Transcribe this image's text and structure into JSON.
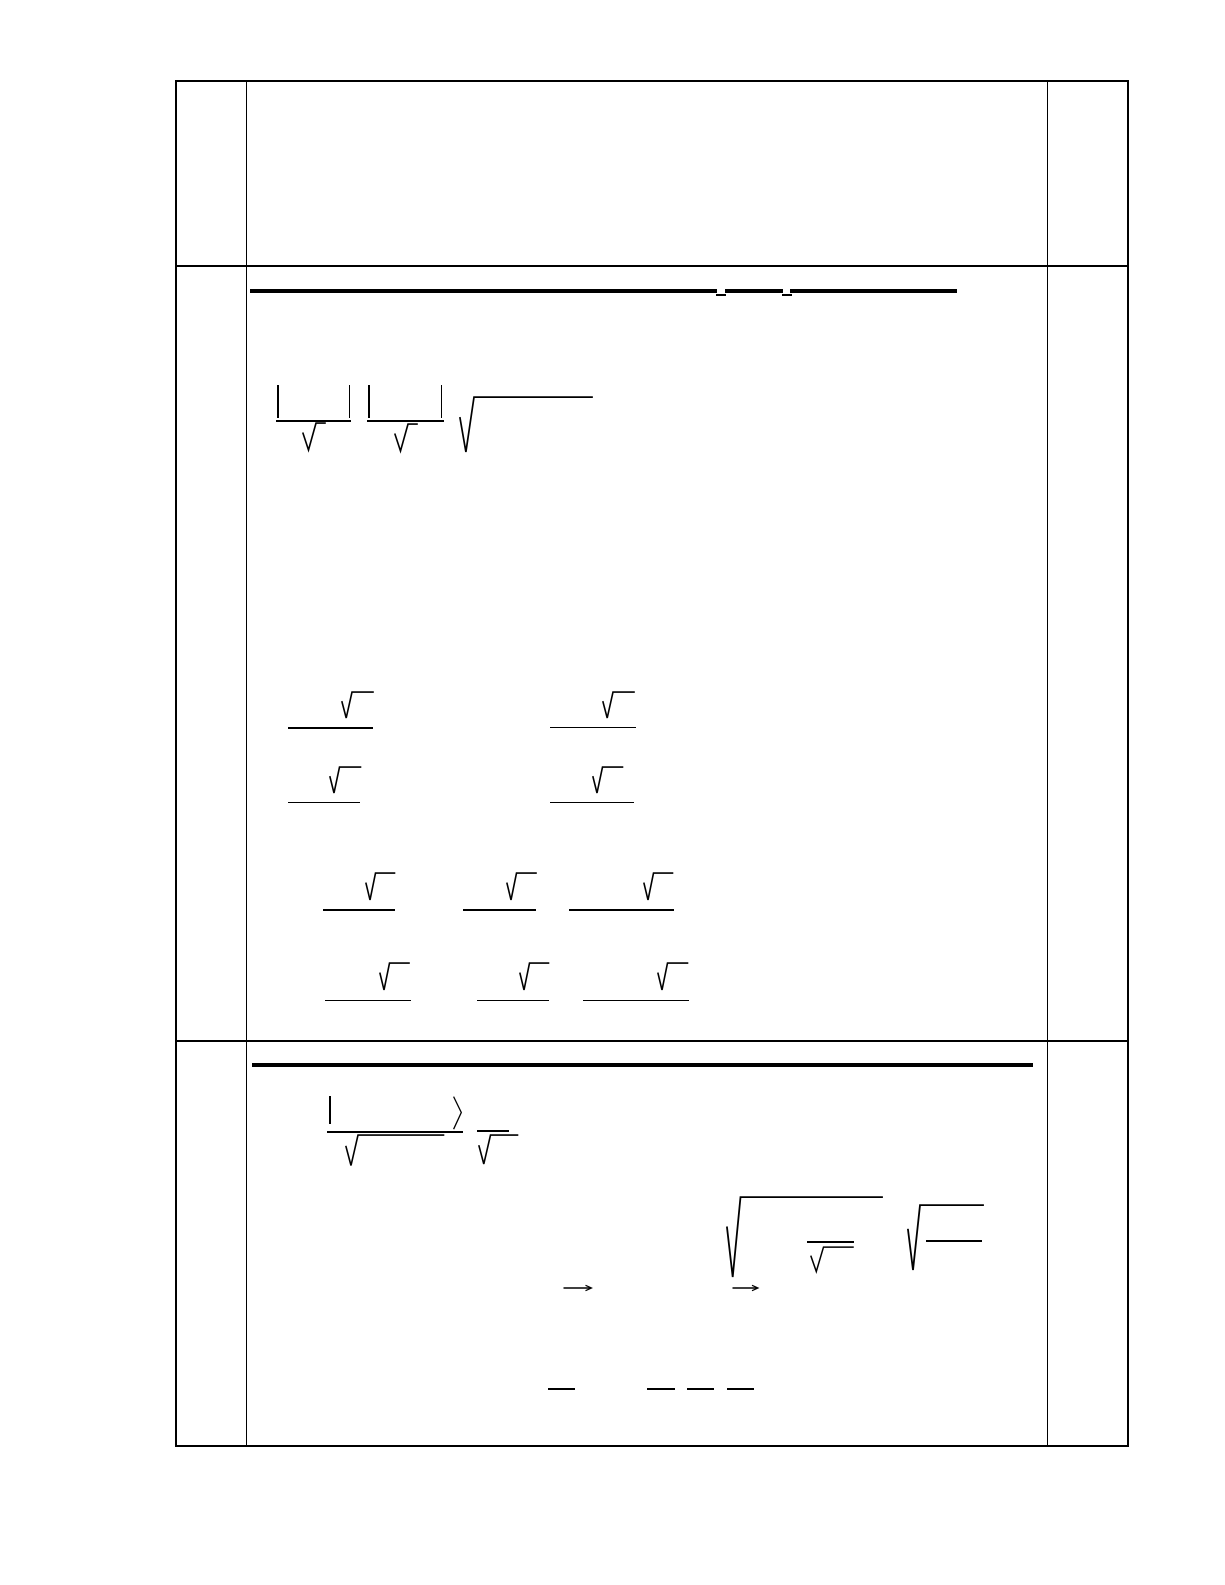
{
  "page": {
    "width": 1225,
    "height": 1585,
    "paper": "#ffffff",
    "ink": "#000000"
  },
  "table": {
    "left": 175,
    "top": 80,
    "right": 1127,
    "bottom": 1444.8,
    "outer_stroke": 2.4,
    "inner_stroke": 1.9,
    "column_x": [
      245.5,
      1046.5
    ],
    "row_y": [
      265.3,
      1040
    ]
  },
  "primitives": [
    {
      "type": "hline",
      "name": "s1-title-rule-seg-1",
      "x": 250,
      "y": 288.5,
      "w": 466.5,
      "t": 4.6
    },
    {
      "type": "hline",
      "name": "s1-title-underscore-1",
      "x": 715.5,
      "y": 294,
      "w": 10,
      "t": 2.2
    },
    {
      "type": "hline",
      "name": "s1-title-rule-seg-2",
      "x": 725,
      "y": 288.5,
      "w": 58,
      "t": 4.6
    },
    {
      "type": "hline",
      "name": "s1-title-underscore-2",
      "x": 781.5,
      "y": 294,
      "w": 10,
      "t": 2.2
    },
    {
      "type": "hline",
      "name": "s1-title-rule-seg-3",
      "x": 790,
      "y": 288.5,
      "w": 167,
      "t": 4.6
    },
    {
      "type": "vline",
      "name": "s1-abs1-left-bar",
      "x": 277,
      "y": 384.5,
      "h": 33,
      "t": 1.7
    },
    {
      "type": "vline",
      "name": "s1-abs1-right-bar",
      "x": 348.5,
      "y": 384.5,
      "h": 33,
      "t": 1.7
    },
    {
      "type": "hline",
      "name": "s1-abs1-fraction-bar",
      "x": 276,
      "y": 419.5,
      "w": 75,
      "t": 2
    },
    {
      "type": "radical",
      "name": "s1-abs1-sqrt",
      "x": 302.5,
      "y": 423,
      "gw": 13,
      "h": 27,
      "vw": 9,
      "t": 1.6
    },
    {
      "type": "vline",
      "name": "s1-abs2-left-bar",
      "x": 368,
      "y": 384.5,
      "h": 33,
      "t": 1.7
    },
    {
      "type": "vline",
      "name": "s1-abs2-right-bar",
      "x": 440.5,
      "y": 384.5,
      "h": 33,
      "t": 1.7
    },
    {
      "type": "hline",
      "name": "s1-abs2-fraction-bar",
      "x": 367,
      "y": 420,
      "w": 77,
      "t": 2
    },
    {
      "type": "radical",
      "name": "s1-abs2-sqrt",
      "x": 394.5,
      "y": 423.5,
      "gw": 13,
      "h": 27,
      "vw": 9,
      "t": 1.6
    },
    {
      "type": "radical",
      "name": "s1-long-sqrt",
      "x": 460,
      "y": 396.5,
      "gw": 14,
      "h": 55,
      "vw": 118,
      "t": 1.7
    },
    {
      "type": "radical",
      "name": "s1-frac-r1-left-sqrt",
      "x": 341.5,
      "y": 691.5,
      "gw": 10,
      "h": 26,
      "vw": 21,
      "t": 1.6
    },
    {
      "type": "hline",
      "name": "s1-frac-r1-left-bar",
      "x": 287.5,
      "y": 727,
      "w": 85,
      "t": 1.8
    },
    {
      "type": "radical",
      "name": "s1-frac-r1-right-sqrt",
      "x": 603,
      "y": 691.5,
      "gw": 10,
      "h": 26,
      "vw": 21,
      "t": 1.6
    },
    {
      "type": "hline",
      "name": "s1-frac-r1-right-bar",
      "x": 550,
      "y": 726.5,
      "w": 86,
      "t": 1.8
    },
    {
      "type": "radical",
      "name": "s1-frac-r2-left-sqrt",
      "x": 330,
      "y": 766.5,
      "gw": 9.5,
      "h": 26,
      "vw": 21,
      "t": 1.6
    },
    {
      "type": "hline",
      "name": "s1-frac-r2-left-bar",
      "x": 287.5,
      "y": 801.5,
      "w": 72.5,
      "t": 1.8
    },
    {
      "type": "radical",
      "name": "s1-frac-r2-right-sqrt",
      "x": 592.5,
      "y": 766.5,
      "gw": 9.5,
      "h": 26,
      "vw": 20,
      "t": 1.6
    },
    {
      "type": "hline",
      "name": "s1-frac-r2-right-bar",
      "x": 550,
      "y": 801.5,
      "w": 83.5,
      "t": 1.8
    },
    {
      "type": "radical",
      "name": "s1-frac-r3-a-sqrt",
      "x": 366,
      "y": 872.5,
      "gw": 9.5,
      "h": 27,
      "vw": 19,
      "t": 1.6
    },
    {
      "type": "hline",
      "name": "s1-frac-r3-a-bar",
      "x": 323,
      "y": 909,
      "w": 72,
      "t": 1.8
    },
    {
      "type": "radical",
      "name": "s1-frac-r3-b-sqrt",
      "x": 506.5,
      "y": 872.5,
      "gw": 9.5,
      "h": 27,
      "vw": 19.5,
      "t": 1.6
    },
    {
      "type": "hline",
      "name": "s1-frac-r3-b-bar",
      "x": 462.5,
      "y": 909,
      "w": 73.5,
      "t": 1.8
    },
    {
      "type": "radical",
      "name": "s1-frac-r3-c-sqrt",
      "x": 644,
      "y": 872.5,
      "gw": 9.5,
      "h": 27,
      "vw": 19,
      "t": 1.6
    },
    {
      "type": "hline",
      "name": "s1-frac-r3-c-bar",
      "x": 568.5,
      "y": 909,
      "w": 105,
      "t": 1.8
    },
    {
      "type": "radical",
      "name": "s1-frac-r4-a-sqrt",
      "x": 380,
      "y": 963,
      "gw": 9.5,
      "h": 27,
      "vw": 19.5,
      "t": 1.6
    },
    {
      "type": "hline",
      "name": "s1-frac-r4-a-bar",
      "x": 325,
      "y": 999.5,
      "w": 86,
      "t": 1.8
    },
    {
      "type": "radical",
      "name": "s1-frac-r4-b-sqrt",
      "x": 519.5,
      "y": 963,
      "gw": 9.5,
      "h": 27,
      "vw": 19,
      "t": 1.6
    },
    {
      "type": "hline",
      "name": "s1-frac-r4-b-bar",
      "x": 476.5,
      "y": 999.5,
      "w": 72,
      "t": 1.8
    },
    {
      "type": "radical",
      "name": "s1-frac-r4-c-sqrt",
      "x": 657.5,
      "y": 963,
      "gw": 9.5,
      "h": 27,
      "vw": 20,
      "t": 1.6
    },
    {
      "type": "hline",
      "name": "s1-frac-r4-c-bar",
      "x": 582.5,
      "y": 999.5,
      "w": 106,
      "t": 1.8
    },
    {
      "type": "hline",
      "name": "s2-title-rule",
      "x": 252,
      "y": 1062.5,
      "w": 781,
      "t": 4.6
    },
    {
      "type": "vline",
      "name": "s2-inner-left-bar",
      "x": 329,
      "y": 1095.5,
      "h": 28.5,
      "t": 1.7
    },
    {
      "type": "rangle",
      "name": "s2-right-angle-bracket",
      "x": 452.5,
      "y": 1095.5,
      "w": 8.5,
      "h": 33,
      "t": 1.3
    },
    {
      "type": "hline",
      "name": "s2-frac1-bar",
      "x": 327,
      "y": 1130.5,
      "w": 135.5,
      "t": 2
    },
    {
      "type": "radical",
      "name": "s2-frac1-sqrt",
      "x": 346,
      "y": 1134.5,
      "gw": 12,
      "h": 30.5,
      "vw": 85.5,
      "t": 1.6
    },
    {
      "type": "hline",
      "name": "s2-frac2-bar",
      "x": 476.5,
      "y": 1129.5,
      "w": 32,
      "t": 2
    },
    {
      "type": "radical",
      "name": "s2-frac2-sqrt",
      "x": 478.5,
      "y": 1134.5,
      "gw": 11.5,
      "h": 29,
      "vw": 27,
      "t": 1.6
    },
    {
      "type": "radical",
      "name": "s2-big-sqrt-1",
      "x": 726.5,
      "y": 1196.5,
      "gw": 13.5,
      "h": 80,
      "vw": 141.5,
      "t": 1.8
    },
    {
      "type": "hline",
      "name": "s2-big-sqrt-1-inner-bar",
      "x": 806.5,
      "y": 1241,
      "w": 47,
      "t": 1.8
    },
    {
      "type": "radical",
      "name": "s2-big-sqrt-1-inner-sqrt",
      "x": 811,
      "y": 1247,
      "gw": 12.5,
      "h": 24.5,
      "vw": 29.5,
      "t": 1.5
    },
    {
      "type": "radical",
      "name": "s2-big-sqrt-2",
      "x": 908,
      "y": 1205,
      "gw": 12,
      "h": 65,
      "vw": 63,
      "t": 1.8
    },
    {
      "type": "hline",
      "name": "s2-big-sqrt-2-inner-bar",
      "x": 926,
      "y": 1240,
      "w": 56,
      "t": 1.8
    },
    {
      "type": "arrow",
      "name": "s2-limit-arrow-1",
      "x": 563,
      "y": 1288.3,
      "w": 28
    },
    {
      "type": "arrow",
      "name": "s2-limit-arrow-2",
      "x": 731.5,
      "y": 1288.3,
      "w": 25.5
    },
    {
      "type": "hline",
      "name": "s2-small-fraction-bar-1",
      "x": 547.5,
      "y": 1387.5,
      "w": 27.5,
      "t": 2.3
    },
    {
      "type": "hline",
      "name": "s2-small-fraction-bar-2",
      "x": 646.5,
      "y": 1387.5,
      "w": 28,
      "t": 2.3
    },
    {
      "type": "hline",
      "name": "s2-small-fraction-bar-3",
      "x": 686.5,
      "y": 1387.5,
      "w": 27,
      "t": 2.3
    },
    {
      "type": "hline",
      "name": "s2-small-fraction-bar-4",
      "x": 726.5,
      "y": 1387.5,
      "w": 27,
      "t": 2.3
    }
  ]
}
